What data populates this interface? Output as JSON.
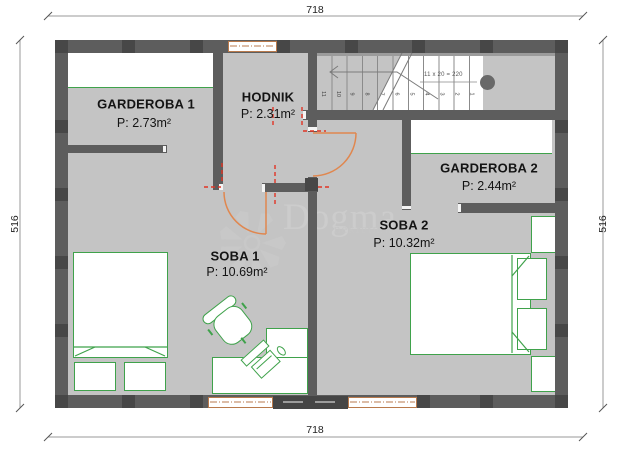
{
  "title": "floor-plan",
  "dimensions": {
    "top": "718",
    "bottom": "718",
    "left": "516",
    "right": "516"
  },
  "rooms": {
    "garderoba1": {
      "name": "GARDEROBA 1",
      "area": "P: 2.73m²"
    },
    "hodnik": {
      "name": "HODNIK",
      "area": "P: 2.31m²"
    },
    "garderoba2": {
      "name": "GARDEROBA 2",
      "area": "P: 2.44m²"
    },
    "soba1": {
      "name": "SOBA 1",
      "area": "P: 10.69m²"
    },
    "soba2": {
      "name": "SOBA 2",
      "area": "P: 10.32m²"
    }
  },
  "stairs": {
    "note": "11 x 20 = 220",
    "treads": [
      "11",
      "10",
      "9",
      "8",
      "7",
      "6",
      "5",
      "4",
      "3",
      "2",
      "1"
    ]
  },
  "watermark": {
    "brand": "Dogma",
    "sub": "nekretnine"
  },
  "colors": {
    "wall": "#5d5d5d",
    "wall_dark": "#474747",
    "floor": "#c4c4c4",
    "furniture_green": "#3fa24b",
    "door_orange": "#e0874f",
    "window_tan": "#b97a4c",
    "demolition_red": "#e23424",
    "watermark_gray": "#c9c9c9"
  }
}
